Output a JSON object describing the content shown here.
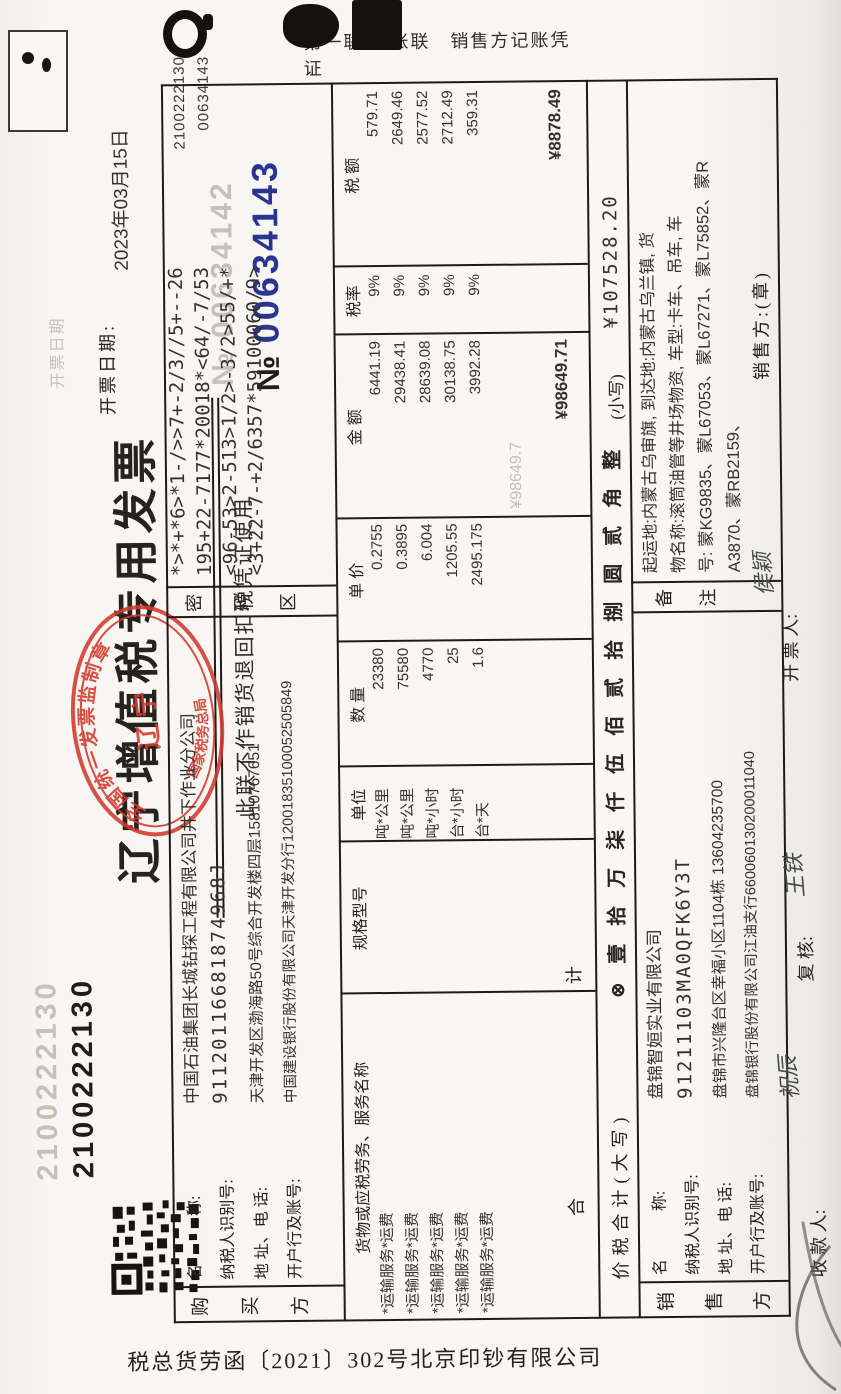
{
  "header": {
    "code_top_left": "2100222130",
    "code_top_left_ghost": "2100222130",
    "title": "辽宁增值税专用发票",
    "subtitle": "此联不作销货退回扣税凭证使用",
    "no_symbol": "№",
    "invoice_no": "00634143",
    "invoice_no_ghost": "№ 00634142",
    "corner_code": "2100222130",
    "corner_no": "00634143",
    "date_label": "开票日期:",
    "date_value": "2023年03月15日",
    "date_ghost": "开票日期",
    "copy_label": "第一联:记账联　销售方记账凭证",
    "stamp": {
      "top_arc": "全国统一发票监制章",
      "center": "辽  宁",
      "bottom_arc": "国家税务总局"
    }
  },
  "buyer": {
    "side_label": {
      "c1": "购",
      "c2": "买",
      "c3": "方"
    },
    "rows": [
      {
        "label": "名　　　称:",
        "value": "中国石油集团长城钻探工程有限公司井下作业分公司"
      },
      {
        "label": "纳税人识别号:",
        "value": "91120116681874968J"
      },
      {
        "label": "地 址、电 话:",
        "value": "天津开发区渤海路50号综合开发楼四层15810767651"
      },
      {
        "label": "开户行及账号:",
        "value": "中国建设银行股份有限公司天津开发分行12001835100052505849"
      }
    ]
  },
  "password_area": {
    "label": {
      "c1": "密",
      "c2": "码",
      "c3": "区"
    },
    "lines": [
      "*>*+*6>*1-/>>7+-2/3//5+--26",
      "195+22-7177*20018*<64/-7/53",
      "<96-53>2-513>1/2>-3/2>55/+*",
      "<3+22-7-+2/6357*59100060/9>"
    ]
  },
  "table": {
    "headers": [
      "货物或应税劳务、服务名称",
      "规格型号",
      "单位",
      "数  量",
      "单  价",
      "金  额",
      "税率",
      "税  额"
    ],
    "rows": [
      {
        "name": "*运输服务*运费",
        "spec": "",
        "unit": "吨*公里",
        "qty": "23380",
        "price": "0.2755",
        "amount": "6441.19",
        "tax_rate": "9%",
        "tax": "579.71"
      },
      {
        "name": "*运输服务*运费",
        "spec": "",
        "unit": "吨*公里",
        "qty": "75580",
        "price": "0.3895",
        "amount": "29438.41",
        "tax_rate": "9%",
        "tax": "2649.46"
      },
      {
        "name": "*运输服务*运费",
        "spec": "",
        "unit": "吨*小时",
        "qty": "4770",
        "price": "6.004",
        "amount": "28639.08",
        "tax_rate": "9%",
        "tax": "2577.52"
      },
      {
        "name": "*运输服务*运费",
        "spec": "",
        "unit": "台*小时",
        "qty": "25",
        "price": "1205.55",
        "amount": "30138.75",
        "tax_rate": "9%",
        "tax": "2712.49"
      },
      {
        "name": "*运输服务*运费",
        "spec": "",
        "unit": "台*天",
        "qty": "1.6",
        "price": "2495.175",
        "amount": "3992.28",
        "tax_rate": "9%",
        "tax": "359.31"
      }
    ],
    "total_label": "合　　　计",
    "total_amount": "¥98649.71",
    "total_tax": "¥8878.49",
    "total_amount_ghost": "¥98649.7"
  },
  "summary": {
    "label": "价税合计(大写)",
    "capital": "⊗壹拾万柒仟伍佰贰拾捌圆贰角整",
    "small_label": "(小写)",
    "small_value": "¥107528.20"
  },
  "seller": {
    "side_label": {
      "c1": "销",
      "c2": "售",
      "c3": "方"
    },
    "rows": [
      {
        "label": "名　　　称:",
        "value": "盘锦智姮实业有限公司"
      },
      {
        "label": "纳税人识别号:",
        "value": "91211103MA0QFK6Y3T"
      },
      {
        "label": "地 址、电 话:",
        "value": "盘锦市兴隆台区幸福小区1104栋 13604235700"
      },
      {
        "label": "开户行及账号:",
        "value": "盘锦银行股份有限公司江油支行660060130200011040"
      }
    ]
  },
  "remark": {
    "label": {
      "c1": "备",
      "c2": "注"
    },
    "lines": [
      "起运地:内蒙古乌审旗, 到达地:内蒙古乌兰镇, 货",
      "物名称:滚筒油管等井场物资, 车型:卡车、吊车, 车",
      "号: 蒙KG9835、蒙L67053、蒙L67271、蒙L75852、蒙R",
      "A3870、蒙RB2159、"
    ]
  },
  "footer": {
    "payee_label": "收 款 人:",
    "payee": "祝辰",
    "reviewer_label": "复 核:",
    "reviewer": "王铁",
    "drawer_label": "开 票 人:",
    "drawer": "侯颖",
    "seller_stamp_label": "销售方:(章)"
  },
  "print_ref": "税总货劳函〔2021〕302号北京印钞有限公司"
}
